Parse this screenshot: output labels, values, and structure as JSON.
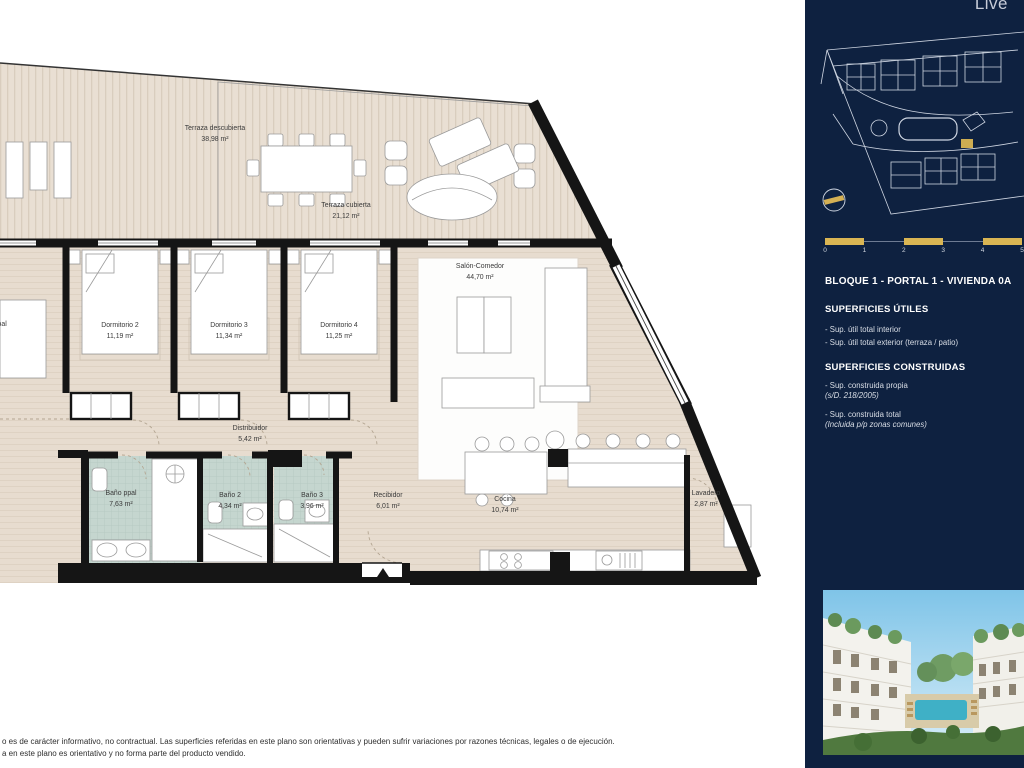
{
  "plan": {
    "rooms": [
      {
        "name": "Terraza descubierta",
        "area": "38,98 m²"
      },
      {
        "name": "Terraza cubierta",
        "area": "21,12 m²"
      },
      {
        "name": "Dormitorio ppal"
      },
      {
        "name": "Dormitorio 2",
        "area": "11,19 m²"
      },
      {
        "name": "Dormitorio 3",
        "area": "11,34 m²"
      },
      {
        "name": "Dormitorio 4",
        "area": "11,25 m²"
      },
      {
        "name": "Salón-Comedor",
        "area": "44,70 m²"
      },
      {
        "name": "Distribuidor",
        "area": "5,42 m²"
      },
      {
        "name": "Baño ppal",
        "area": "7,63 m²"
      },
      {
        "name": "Baño 2",
        "area": "4,34 m²"
      },
      {
        "name": "Baño 3",
        "area": "3,96 m²"
      },
      {
        "name": "Recibidor",
        "area": "6,01 m²"
      },
      {
        "name": "Cocina",
        "area": "10,74 m²"
      },
      {
        "name": "Lavadero",
        "area": "2,87 m²"
      }
    ]
  },
  "sidebar": {
    "logo_fragment": "Live",
    "unit_title": "BLOQUE 1 - PORTAL 1 - VIVIENDA 0A",
    "scale": {
      "ticks": [
        "0",
        "1",
        "2",
        "3",
        "4",
        "5"
      ]
    },
    "sections": [
      {
        "heading": "SUPERFICIES ÚTILES",
        "items": [
          {
            "label": "- Sup. útil total interior"
          },
          {
            "label": "- Sup. útil total exterior (terraza / patio)"
          }
        ]
      },
      {
        "heading": "SUPERFICIES CONSTRUIDAS",
        "items": [
          {
            "label": "- Sup. construida propia",
            "note": "(s/D. 218/2005)"
          },
          {
            "label": "- Sup. construida total",
            "note": "(Incluida p/p zonas comunes)"
          }
        ]
      }
    ]
  },
  "footer": {
    "line1": "o es de carácter informativo, no contractual. Las superficies referidas en este plano son orientativas y pueden sufrir variaciones por razones técnicas, legales o de ejecución.",
    "line2": "a en este plano es orientativo y no forma parte del producto vendido."
  },
  "colors": {
    "sidebar_navy": "#0e2140",
    "accent_gold": "#d9b553",
    "deck_beige": "#e9dfd3",
    "floor_beige": "#e7dccf",
    "bath_tile": "#c5d6cf",
    "wall_black": "#151515"
  }
}
